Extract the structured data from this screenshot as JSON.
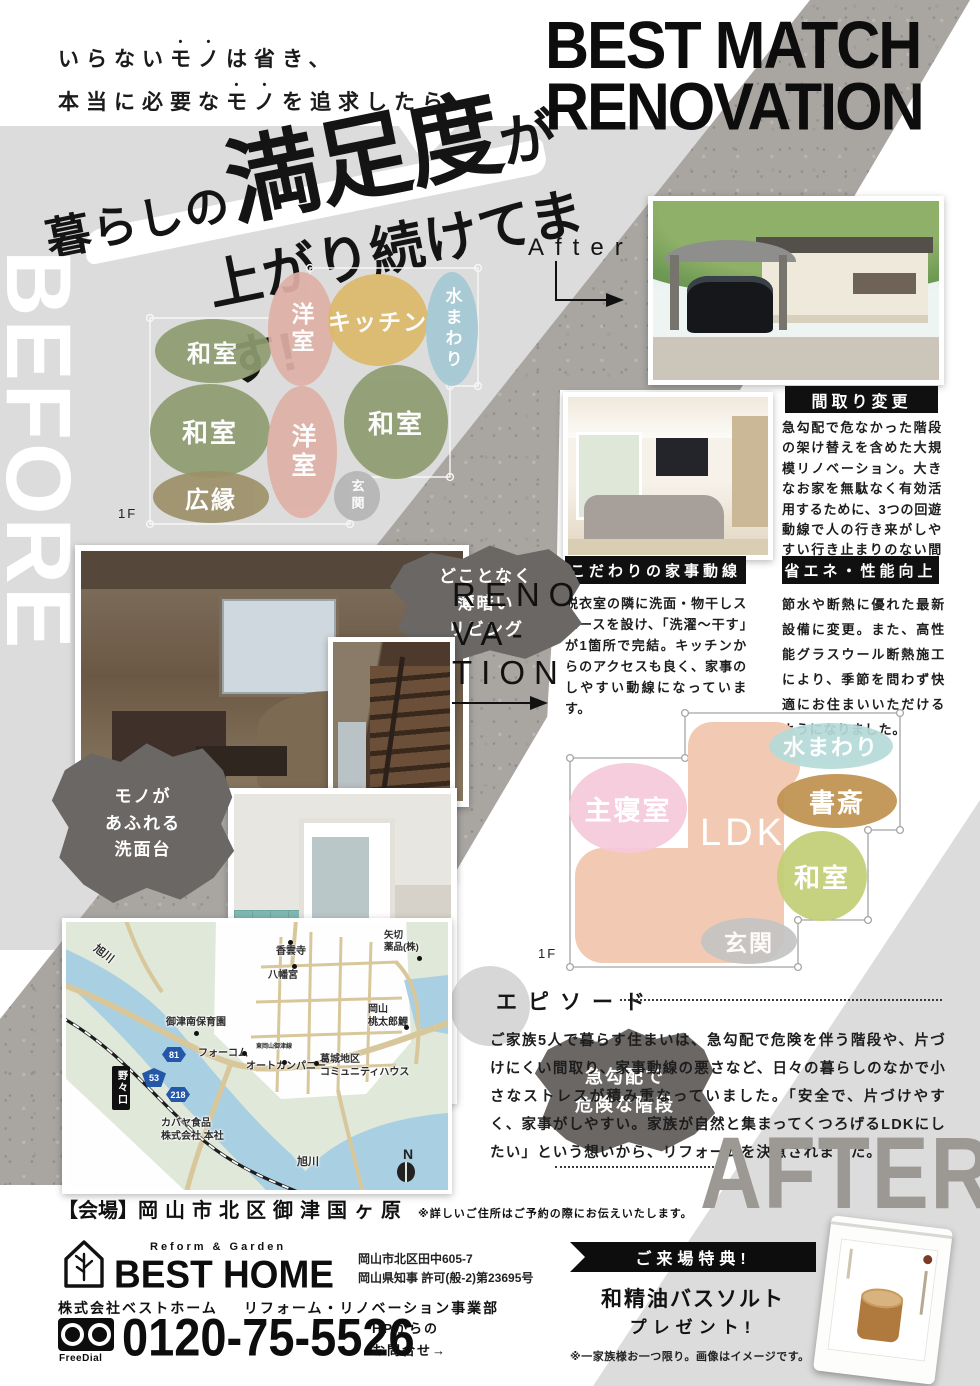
{
  "slogan": {
    "l1a": "いらない",
    "l1b": "モノ",
    "l1c": "は省き、",
    "l2a": "本当に必要な",
    "l2b": "モノ",
    "l2c": "を追求したら、"
  },
  "headline": {
    "p1": "暮らしの",
    "p2": "満足度",
    "p3": "が",
    "line2": "上がり続けてます!"
  },
  "title": {
    "line1": "BEST MATCH",
    "line2": "RENOVATION"
  },
  "before_label": "BEFORE",
  "after_big_label": "AFTER",
  "after_small_label": "After",
  "renovation_word": {
    "l1": "RENO",
    "l2": "VA-",
    "l3": "TION"
  },
  "before_plan": {
    "floor": "1F",
    "rooms": [
      {
        "label": "和室",
        "x": 213,
        "y": 351,
        "rx": 58,
        "ry": 32,
        "color": "#8e9b6f",
        "fs": 24
      },
      {
        "label": "洋室",
        "x": 301,
        "y": 329,
        "rx": 33,
        "ry": 57,
        "color": "#dfb0a5",
        "fs": 23,
        "vert": true
      },
      {
        "label": "キッチン",
        "x": 378,
        "y": 320,
        "rx": 50,
        "ry": 46,
        "color": "#dcb96a",
        "fs": 23
      },
      {
        "label": "水まわり",
        "x": 452,
        "y": 329,
        "rx": 26,
        "ry": 57,
        "color": "#a3c9d4",
        "fs": 17,
        "vert": true
      },
      {
        "label": "和室",
        "x": 210,
        "y": 431,
        "rx": 60,
        "ry": 47,
        "color": "#8e9b6f",
        "fs": 26
      },
      {
        "label": "洋室",
        "x": 302,
        "y": 452,
        "rx": 35,
        "ry": 66,
        "color": "#dfb0a5",
        "fs": 25,
        "vert": true
      },
      {
        "label": "和室",
        "x": 396,
        "y": 422,
        "rx": 52,
        "ry": 57,
        "color": "#8e9b6f",
        "fs": 26
      },
      {
        "label": "広縁",
        "x": 211,
        "y": 497,
        "rx": 58,
        "ry": 26,
        "color": "#9c9168",
        "fs": 24
      },
      {
        "label": "玄関",
        "x": 357,
        "y": 496,
        "rx": 23,
        "ry": 25,
        "color": "#b5b5b5",
        "fs": 13,
        "vert": true
      }
    ]
  },
  "after_plan": {
    "floor": "1F",
    "ldk": {
      "label": "LDK",
      "color": "#f2cab4",
      "parts": [
        {
          "x": 688,
          "y": 722,
          "w": 96,
          "h": 241,
          "r": 28
        },
        {
          "x": 575,
          "y": 848,
          "w": 206,
          "h": 115,
          "r": 28
        },
        {
          "x": 688,
          "y": 722,
          "w": 112,
          "h": 68,
          "r": 24
        }
      ]
    },
    "rooms": [
      {
        "label": "主寝室",
        "x": 628,
        "y": 808,
        "rx": 59,
        "ry": 45,
        "color": "#f6c9da",
        "fs": 27
      },
      {
        "label": "水まわり",
        "x": 831,
        "y": 746,
        "rx": 62,
        "ry": 23,
        "color": "#b5dbd8",
        "fs": 22
      },
      {
        "label": "書斎",
        "x": 837,
        "y": 801,
        "rx": 60,
        "ry": 27,
        "color": "#c0914f",
        "fs": 26
      },
      {
        "label": "和室",
        "x": 822,
        "y": 876,
        "rx": 45,
        "ry": 45,
        "color": "#c3cf76",
        "fs": 26
      },
      {
        "label": "玄関",
        "x": 749,
        "y": 941,
        "rx": 48,
        "ry": 23,
        "color": "#c4c4c4",
        "fs": 23
      }
    ]
  },
  "bubbles": [
    {
      "lines": [
        "どことなく",
        "薄暗い",
        "リビング"
      ]
    },
    {
      "lines": [
        "モノが",
        "あふれる",
        "洗面台"
      ]
    },
    {
      "lines": [
        "急勾配で",
        "危険な階段"
      ]
    }
  ],
  "sections": {
    "madori": {
      "title": "間取り変更",
      "body": "急勾配で危なかった階段の架け替えを含めた大規模リノベーション。大きなお家を無駄なく有効活用するために、3つの回遊動線で人の行き来がしやすい行き止まりのない間取りにしています。"
    },
    "kaji": {
      "title": "こだわりの家事動線",
      "body": "脱衣室の隣に洗面・物干しスペースを設け、「洗濯〜干す」が1箇所で完結。キッチンからのアクセスも良く、家事のしやすい動線になっています。"
    },
    "shoene": {
      "title": "省エネ・性能向上",
      "body": "節水や断熱に優れた最新設備に変更。また、高性能グラスウール断熱施工により、季節を問わず快適にお住まいいただけるようになりました。"
    },
    "episode": {
      "title": "エピソード",
      "body": "ご家族5人で暮らす住まいは、急勾配で危険を伴う階段や、片づけにくい間取り、家事動線の悪さなど、日々の暮らしのなかで小さなストレスが積み重なっていました。「安全で、片づけやすく、家事がしやすい。家族が自然と集まってくつろげるLDKにしたい」という想いから、リフォームを決意されました。"
    }
  },
  "venue": {
    "bracket": "【会場】",
    "place": "岡山市北区御津国ヶ原",
    "note": "※詳しいご住所はご予約の際にお伝えいたします。"
  },
  "footer": {
    "tagline": "Reform & Garden",
    "brand": "BEST HOME",
    "address1": "岡山市北区田中605-7",
    "address2": "岡山県知事 許可(般-2)第23695号",
    "company": "株式会社ベストホーム",
    "division": "リフォーム・リノベーション事業部",
    "freedial": "FreeDial",
    "phone": "0120-75-5526",
    "hp1": "HPからの",
    "hp2": "お問合せ→"
  },
  "gift": {
    "ribbon": "ご来場特典!",
    "item": "和精油バスソルト",
    "present": "プレゼント!",
    "note": "※一家族様お一つ限り。画像はイメージです。"
  },
  "map": {
    "station": "野々口",
    "compass": "N",
    "badges": [
      {
        "n": "81",
        "x": 96,
        "y": 125,
        "type": "hex"
      },
      {
        "n": "53",
        "x": 76,
        "y": 146,
        "type": "tri"
      },
      {
        "n": "218",
        "x": 100,
        "y": 165,
        "type": "hex"
      }
    ],
    "labels": [
      {
        "t": "旭川",
        "x": 26,
        "y": 26,
        "fs": 11,
        "rot": 38
      },
      {
        "t": "香雲寺",
        "x": 210,
        "y": 24,
        "fs": 10,
        "dot": [
          222,
          18
        ]
      },
      {
        "t": "八幡宮",
        "x": 202,
        "y": 48,
        "fs": 10,
        "dot": [
          226,
          42
        ]
      },
      {
        "t": "矢切\n薬品(株)",
        "x": 318,
        "y": 8,
        "fs": 9.5,
        "dot": [
          351,
          34
        ]
      },
      {
        "t": "御津南保育園",
        "x": 100,
        "y": 95,
        "fs": 10,
        "dot": [
          128,
          109
        ]
      },
      {
        "t": "岡山\n桃太郎鯉",
        "x": 302,
        "y": 82,
        "fs": 10,
        "dot": [
          338,
          103
        ]
      },
      {
        "t": "フォーコム",
        "x": 132,
        "y": 126,
        "fs": 10,
        "dot": [
          176,
          129
        ]
      },
      {
        "t": "東岡山御津線",
        "x": 190,
        "y": 122,
        "fs": 6
      },
      {
        "t": "オートカンパニー",
        "x": 180,
        "y": 139,
        "fs": 10,
        "dot": [
          216,
          138
        ]
      },
      {
        "t": "葛城地区\nコミュニティハウス",
        "x": 254,
        "y": 132,
        "fs": 10,
        "dot": [
          248,
          139
        ]
      },
      {
        "t": "カバヤ食品\n株式会社 本社",
        "x": 95,
        "y": 196,
        "fs": 10
      },
      {
        "t": "旭川",
        "x": 231,
        "y": 234,
        "fs": 11
      }
    ]
  }
}
